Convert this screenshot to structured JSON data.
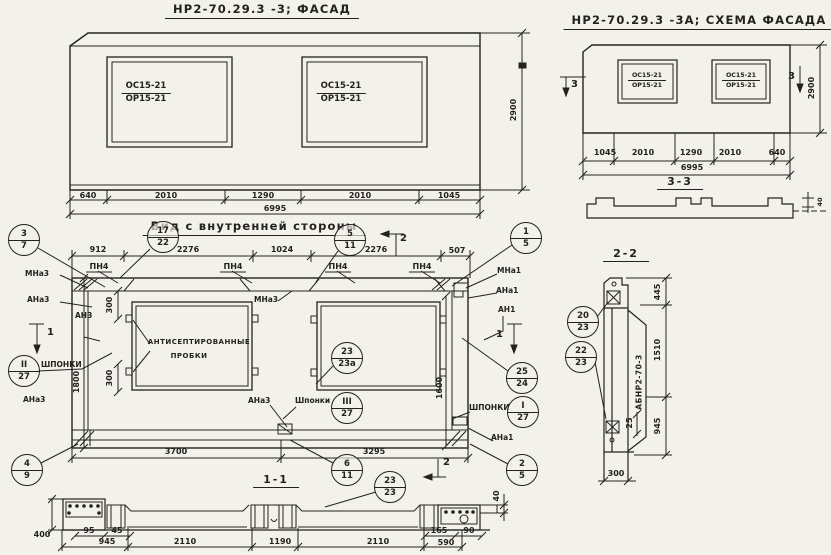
{
  "facade": {
    "title": "НР2-70.29.3 -3; ФАСАД",
    "win_num": "ОС15-21",
    "win_den": "ОР15-21",
    "dims": [
      "640",
      "2010",
      "1290",
      "2010",
      "1045"
    ],
    "total": "6995",
    "height": "2900"
  },
  "scheme": {
    "title": "НР2-70.29.3 -3А; СХЕМА ФАСАДА",
    "win_num": "ОС15-21",
    "win_den": "ОР15-21",
    "dims": [
      "1045",
      "2010",
      "1290",
      "2010",
      "640"
    ],
    "total": "6995",
    "height": "2900",
    "mark": "3",
    "section_title": "3-3",
    "thickness": "40"
  },
  "inner": {
    "title": "Вид с внутренней стороны",
    "top_dims": [
      "912",
      "2276",
      "1024",
      "2276",
      "507"
    ],
    "pn4": "ПН4",
    "mna3": "МНа3",
    "ana3": "АНа3",
    "an3": "АН3",
    "mna1": "МНа1",
    "ana1": "АНа1",
    "an1": "АН1",
    "shponki": "ШПОНКИ",
    "shponki_lc": "Шпонки",
    "plugs_line1": "АНТИСЕПТИРОВАННЫЕ",
    "plugs_line2": "ПРОБКИ",
    "h_left": "1800",
    "h_right": "1600",
    "d300": "300",
    "bottom_dims": [
      "3700",
      "3295"
    ],
    "mark1": "1",
    "mark2": "2"
  },
  "s11": {
    "title": "1-1",
    "d400": "400",
    "d95": "95",
    "d45": "45",
    "d40": "40",
    "d945": "945",
    "d2110": "2110",
    "d1190": "1190",
    "d590": "590",
    "d165": "165",
    "d90": "90"
  },
  "s22": {
    "title": "2-2",
    "stamp": "АБНР2-70-3",
    "d445": "445",
    "d1510": "1510",
    "d945": "945",
    "d25": "25",
    "d300": "300"
  },
  "circles": {
    "c3_7": {
      "t": "3",
      "b": "7"
    },
    "c17_22": {
      "t": "17",
      "b": "22"
    },
    "c5_11": {
      "t": "5",
      "b": "11"
    },
    "c1_5": {
      "t": "1",
      "b": "5"
    },
    "cII_27": {
      "t": "II",
      "b": "27"
    },
    "c4_9": {
      "t": "4",
      "b": "9"
    },
    "c23_23a": {
      "t": "23",
      "b": "23а"
    },
    "cIII_27": {
      "t": "III",
      "b": "27"
    },
    "c25_24": {
      "t": "25",
      "b": "24"
    },
    "cI_27": {
      "t": "I",
      "b": "27"
    },
    "c2_5": {
      "t": "2",
      "b": "5"
    },
    "c6_11": {
      "t": "6",
      "b": "11"
    },
    "c23_23": {
      "t": "23",
      "b": "23"
    },
    "c20_23": {
      "t": "20",
      "b": "23"
    },
    "c22_23": {
      "t": "22",
      "b": "23"
    }
  }
}
